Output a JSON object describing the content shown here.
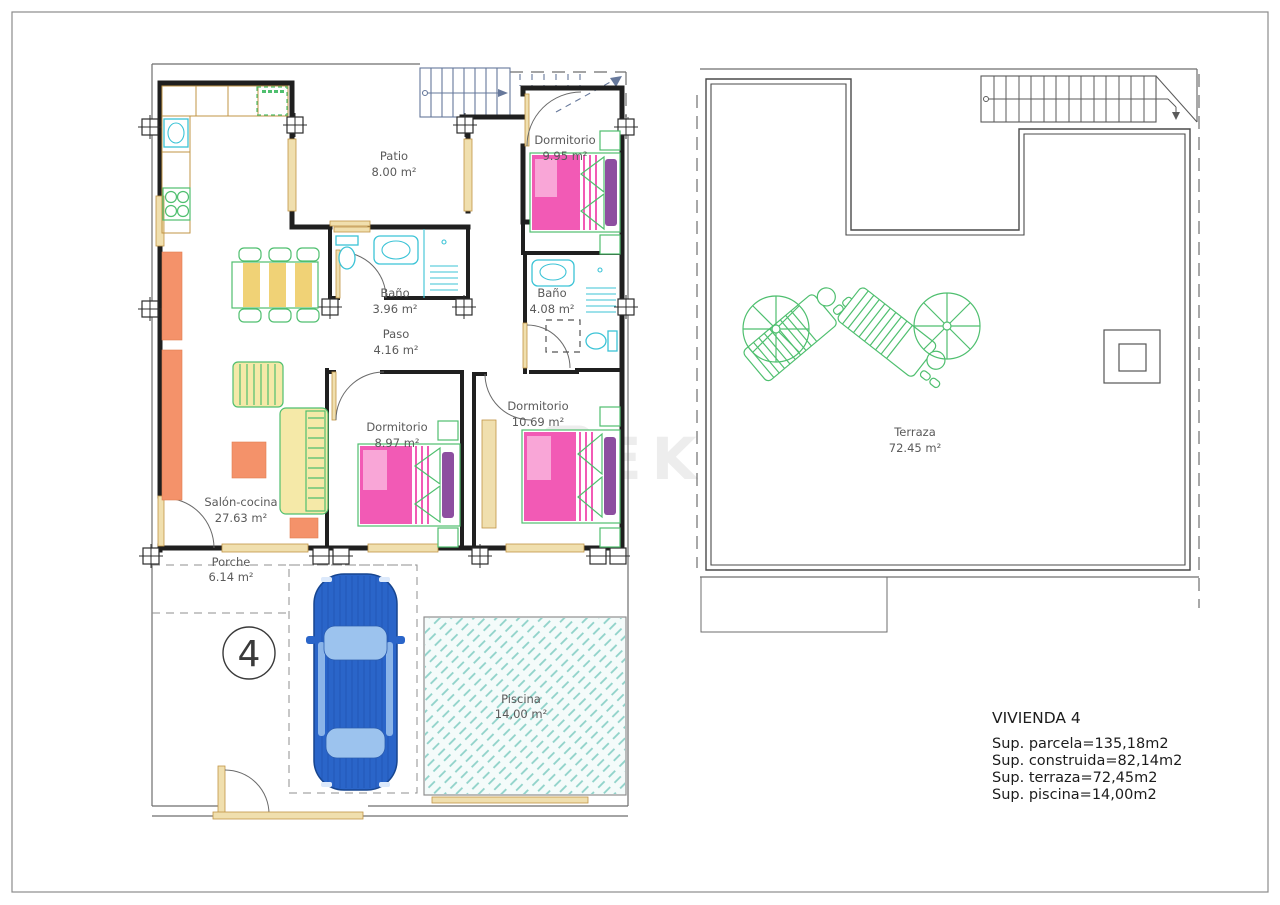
{
  "ground_floor": {
    "labels": {
      "patio": {
        "name": "Patio",
        "area": "8.00 m²"
      },
      "dormitorio_1": {
        "name": "Dormitorio",
        "area": "9.95 m²"
      },
      "bano_1": {
        "name": "Baño",
        "area": "3.96 m²"
      },
      "bano_2": {
        "name": "Baño",
        "area": "4.08 m²"
      },
      "paso": {
        "name": "Paso",
        "area": "4.16 m²"
      },
      "salon_cocina": {
        "name": "Salón-cocina",
        "area": "27.63 m²"
      },
      "dormitorio_2": {
        "name": "Dormitorio",
        "area": "8.97 m²"
      },
      "dormitorio_3": {
        "name": "Dormitorio",
        "area": "10.69 m²"
      },
      "porche": {
        "name": "Porche",
        "area": "6.14 m²"
      },
      "piscina": {
        "name": "Piscina",
        "area": "14,00 m²"
      }
    },
    "unit_number": "4"
  },
  "roof_plan": {
    "labels": {
      "terraza": {
        "name": "Terraza",
        "area": "72.45 m²"
      }
    }
  },
  "summary": {
    "title": "VIVIENDA  4",
    "lines": [
      "Sup.  parcela=135,18m2",
      "Sup.  construida=82,14m2",
      "Sup.  terraza=72,45m2",
      "Sup.  piscina=14,00m2"
    ]
  },
  "watermark": {
    "text": "EKCE"
  },
  "colors": {
    "wall": "#1f1f1f",
    "thin": "#6e6e6e",
    "stair_blue": "#66789b",
    "tan": "#f0dfae",
    "tan_stroke": "#c19445",
    "cyan": "#3bc3d6",
    "green": "#4fbf6f",
    "yellow": "#f5e9a8",
    "yellow_deep": "#f0d276",
    "orange": "#f4926a",
    "pink": "#f25ab5",
    "pink_light": "#f9a6d7",
    "purple": "#8d4fa0",
    "car_blue": "#2a65c9",
    "car_glass": "#9cc3ee",
    "pool_teal": "#8fd2c9",
    "label": "#5a5a5a",
    "text_dark": "#1c1c1c",
    "watermark": "#ededed"
  }
}
